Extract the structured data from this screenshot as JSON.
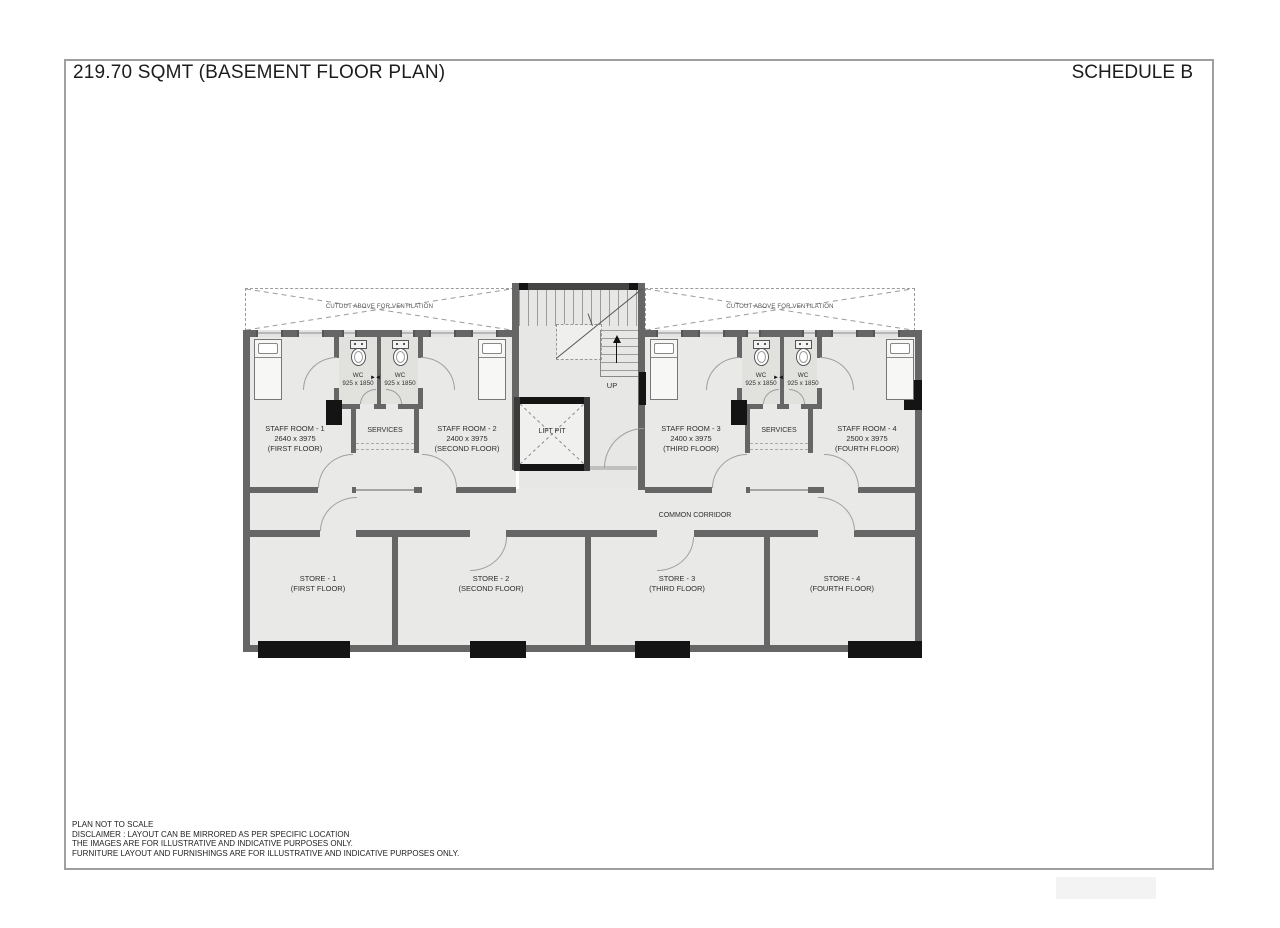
{
  "header": {
    "title": "219.70 SQMT (BASEMENT FLOOR PLAN)",
    "schedule": "SCHEDULE B"
  },
  "footer": {
    "lines": [
      "PLAN NOT TO SCALE",
      "DISCLAIMER : LAYOUT CAN BE MIRRORED AS PER SPECIFIC LOCATION",
      "THE IMAGES ARE FOR ILLUSTRATIVE AND INDICATIVE PURPOSES ONLY.",
      "FURNITURE LAYOUT AND FURNISHINGS ARE FOR ILLUSTRATIVE AND INDICATIVE PURPOSES ONLY."
    ]
  },
  "plan": {
    "ventilation_note": "CUTOUT ABOVE FOR VENTILATION",
    "staff_rooms": [
      {
        "name": "STAFF ROOM - 1",
        "size": "2640 x 3975",
        "floor": "(FIRST FLOOR)"
      },
      {
        "name": "STAFF ROOM - 2",
        "size": "2400 x 3975",
        "floor": "(SECOND FLOOR)"
      },
      {
        "name": "STAFF ROOM - 3",
        "size": "2400 x 3975",
        "floor": "(THIRD FLOOR)"
      },
      {
        "name": "STAFF ROOM - 4",
        "size": "2500 x 3975",
        "floor": "(FOURTH FLOOR)"
      }
    ],
    "wc": {
      "label": "WC",
      "size": "925 x 1850"
    },
    "services": "SERVICES",
    "lift_pit": "LIFT PIT",
    "up": "UP",
    "corridor": "COMMON CORRIDOR",
    "stores": [
      {
        "name": "STORE - 1",
        "floor": "(FIRST FLOOR)"
      },
      {
        "name": "STORE - 2",
        "floor": "(SECOND FLOOR)"
      },
      {
        "name": "STORE - 3",
        "floor": "(THIRD FLOOR)"
      },
      {
        "name": "STORE - 4",
        "floor": "(FOURTH FLOOR)"
      }
    ]
  },
  "colors": {
    "wall": "#666666",
    "wall_dark": "#141414",
    "floor": "#e9e9e7",
    "dashed_line": "#999999",
    "frame_border": "#9f9f9f"
  }
}
